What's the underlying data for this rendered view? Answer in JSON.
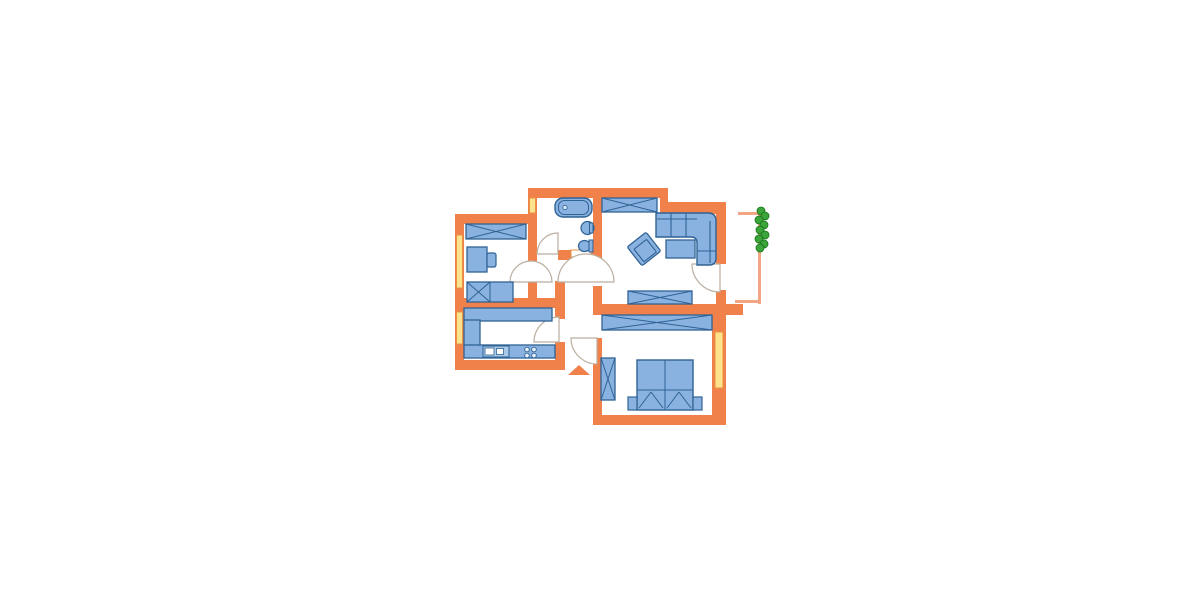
{
  "meta": {
    "description": "apartment floor plan drawing, no text labels visible",
    "entrance_marker": "orange triangle arrow pointing into hallway",
    "rooms": [
      {
        "name": "children-room",
        "position": "top-left",
        "furniture": [
          "wardrobe",
          "desk",
          "desk-chair",
          "single-bed"
        ],
        "windows": 1
      },
      {
        "name": "bathroom",
        "position": "top-middle",
        "furniture": [
          "bathtub",
          "washbasin",
          "toilet",
          "shelf-niche"
        ],
        "windows": 1
      },
      {
        "name": "living-room",
        "position": "top-right",
        "furniture": [
          "wardrobe",
          "corner-sofa",
          "armchair",
          "coffee-table",
          "sideboard"
        ]
      },
      {
        "name": "balcony",
        "position": "right",
        "furniture": [
          "railing",
          "plant"
        ]
      },
      {
        "name": "kitchen",
        "position": "bottom-left",
        "furniture": [
          "counter-u-shape",
          "sink-unit",
          "stove-4-burners"
        ],
        "windows": 1
      },
      {
        "name": "bedroom",
        "position": "bottom-right",
        "furniture": [
          "long-wardrobe",
          "tall-wardrobe",
          "double-bed",
          "nightstand-left",
          "nightstand-right"
        ],
        "windows": 1
      },
      {
        "name": "hallway",
        "position": "center",
        "furniture": []
      }
    ]
  },
  "palette": {
    "wall": "#F0814B",
    "window_fill": "#FFE28E",
    "window_stroke": "#E8933F",
    "furniture_fill": "#8AB2E0",
    "furniture_stroke": "#2F6295",
    "door_arc_stroke": "#BBAE9F",
    "railing": "#F2A585",
    "plant_fill": "#3BA43B",
    "plant_stroke": "#177417",
    "floor": "#FFFFFF"
  },
  "plan": {
    "elements": [
      {
        "n": "wall-bathroom-top",
        "t": "rect",
        "x": 528,
        "y": 188,
        "w": 140,
        "h": 10,
        "f": "#F0814B"
      },
      {
        "n": "wall-top-step",
        "t": "rect",
        "x": 660,
        "y": 188,
        "w": 8,
        "h": 26,
        "f": "#F0814B"
      },
      {
        "n": "wall-living-top",
        "t": "rect",
        "x": 660,
        "y": 202,
        "w": 66,
        "h": 12,
        "f": "#F0814B"
      },
      {
        "n": "wall-bathroom-left",
        "t": "rect",
        "x": 528,
        "y": 188,
        "w": 9,
        "h": 73,
        "f": "#F0814B"
      },
      {
        "n": "wall-children-top",
        "t": "rect",
        "x": 455,
        "y": 214,
        "w": 82,
        "h": 10,
        "f": "#F0814B"
      },
      {
        "n": "wall-children-left",
        "t": "rect",
        "x": 455,
        "y": 214,
        "w": 9,
        "h": 94,
        "f": "#F0814B"
      },
      {
        "n": "wall-children-right-upper",
        "t": "rect",
        "x": 528,
        "y": 224,
        "w": 9,
        "h": 37,
        "f": "#F0814B"
      },
      {
        "n": "wall-children-right-lower",
        "t": "rect",
        "x": 528,
        "y": 281,
        "w": 9,
        "h": 19,
        "f": "#F0814B"
      },
      {
        "n": "wall-kitchen-top",
        "t": "rect",
        "x": 455,
        "y": 298,
        "w": 110,
        "h": 10,
        "f": "#F0814B"
      },
      {
        "n": "wall-kitchen-left",
        "t": "rect",
        "x": 455,
        "y": 298,
        "w": 9,
        "h": 72,
        "f": "#F0814B"
      },
      {
        "n": "wall-kitchen-bottom",
        "t": "rect",
        "x": 455,
        "y": 360,
        "w": 110,
        "h": 10,
        "f": "#F0814B"
      },
      {
        "n": "wall-kitchen-right-upper",
        "t": "rect",
        "x": 555,
        "y": 281,
        "w": 10,
        "h": 38,
        "f": "#F0814B"
      },
      {
        "n": "wall-kitchen-right-lower",
        "t": "rect",
        "x": 555,
        "y": 342,
        "w": 10,
        "h": 28,
        "f": "#F0814B"
      },
      {
        "n": "wall-bathroom-bottom",
        "t": "rect",
        "x": 558,
        "y": 250,
        "w": 44,
        "h": 10,
        "f": "#F0814B"
      },
      {
        "n": "wall-living-left-upper",
        "t": "rect",
        "x": 593,
        "y": 198,
        "w": 9,
        "h": 60,
        "f": "#F0814B"
      },
      {
        "n": "wall-living-left-lower",
        "t": "rect",
        "x": 593,
        "y": 286,
        "w": 9,
        "h": 18,
        "f": "#F0814B"
      },
      {
        "n": "wall-living-bottom",
        "t": "rect",
        "x": 593,
        "y": 304,
        "w": 150,
        "h": 11,
        "f": "#F0814B"
      },
      {
        "n": "wall-living-right-upper",
        "t": "rect",
        "x": 716,
        "y": 212,
        "w": 10,
        "h": 52,
        "f": "#F0814B"
      },
      {
        "n": "wall-living-right-lower",
        "t": "rect",
        "x": 716,
        "y": 290,
        "w": 10,
        "h": 14,
        "f": "#F0814B"
      },
      {
        "n": "wall-bedroom-left",
        "t": "rect",
        "x": 593,
        "y": 338,
        "w": 9,
        "h": 87,
        "f": "#F0814B"
      },
      {
        "n": "wall-bedroom-right",
        "t": "rect",
        "x": 712,
        "y": 304,
        "w": 14,
        "h": 121,
        "f": "#F0814B"
      },
      {
        "n": "wall-bedroom-bottom",
        "t": "rect",
        "x": 593,
        "y": 415,
        "w": 133,
        "h": 10,
        "f": "#F0814B"
      },
      {
        "n": "window-bathroom",
        "t": "rect",
        "x": 529.5,
        "y": 198,
        "w": 6,
        "h": 15,
        "f": "#FFE28E",
        "s": "#E8933F",
        "sw": 1
      },
      {
        "n": "window-children",
        "t": "rect",
        "x": 456.5,
        "y": 235,
        "w": 6,
        "h": 53,
        "f": "#FFE28E",
        "s": "#E8933F",
        "sw": 1
      },
      {
        "n": "window-kitchen",
        "t": "rect",
        "x": 456.5,
        "y": 312,
        "w": 6,
        "h": 32,
        "f": "#FFE28E",
        "s": "#E8933F",
        "sw": 1
      },
      {
        "n": "window-bedroom",
        "t": "rect",
        "x": 715,
        "y": 332,
        "w": 8,
        "h": 56,
        "f": "#FFE28E",
        "s": "#E8933F",
        "sw": 1
      },
      {
        "n": "balcony-railing-top",
        "t": "rect",
        "x": 738,
        "y": 212,
        "w": 23,
        "h": 3,
        "f": "#F2A585"
      },
      {
        "n": "balcony-railing-right",
        "t": "rect",
        "x": 758,
        "y": 212,
        "w": 3,
        "h": 92,
        "f": "#F2A585"
      },
      {
        "n": "balcony-railing-bottom",
        "t": "rect",
        "x": 735,
        "y": 300,
        "w": 26,
        "h": 3,
        "f": "#F2A585"
      },
      {
        "n": "bathroom-shelf-niche",
        "t": "rect",
        "x": 571,
        "y": 250,
        "w": 20,
        "h": 7,
        "f": "#FFFFFF",
        "s": "#E8933F",
        "sw": 1
      },
      {
        "n": "door-swing-children-room",
        "t": "path",
        "d": "M510,282 A21,21 0 0 1 552,282 Z",
        "f": "#FFFFFF",
        "s": "#BBAE9F",
        "sw": 1.2
      },
      {
        "n": "door-swing-living-room",
        "t": "path",
        "d": "M558,282 A28,28 0 0 1 614,282 Z",
        "f": "#FFFFFF",
        "s": "#BBAE9F",
        "sw": 1.2
      },
      {
        "n": "door-swing-bathroom",
        "t": "path",
        "d": "M558,254 L537,254 A21,21 0 0 1 558,233 Z",
        "f": "#FFFFFF",
        "s": "#BBAE9F",
        "sw": 1.2
      },
      {
        "n": "door-swing-kitchen",
        "t": "path",
        "d": "M559,342 L559,317 A25,25 0 0 0 534,342 Z",
        "f": "#FFFFFF",
        "s": "#BBAE9F",
        "sw": 1.2
      },
      {
        "n": "door-swing-bedroom",
        "t": "path",
        "d": "M597,338 L571,338 A26,26 0 0 0 597,364 Z",
        "f": "#FFFFFF",
        "s": "#BBAE9F",
        "sw": 1.2
      },
      {
        "n": "door-swing-balcony",
        "t": "path",
        "d": "M720,264 L692,264 A28,28 0 0 0 720,292 Z",
        "f": "#FFFFFF",
        "s": "#BBAE9F",
        "sw": 1.2
      },
      {
        "n": "children-wardrobe",
        "t": "crossbox",
        "x": 466,
        "y": 224,
        "w": 60,
        "h": 15,
        "f": "#8AB2E0",
        "s": "#2F6295",
        "sw": 1.3
      },
      {
        "n": "children-desk",
        "t": "rect",
        "x": 467,
        "y": 247,
        "w": 20,
        "h": 25,
        "f": "#8AB2E0",
        "s": "#2F6295",
        "sw": 1.3
      },
      {
        "n": "children-desk-chair",
        "t": "rect",
        "x": 487,
        "y": 253,
        "w": 9,
        "h": 14,
        "cr": 2,
        "f": "#8AB2E0",
        "s": "#2F6295",
        "sw": 1.2
      },
      {
        "n": "children-single-bed",
        "t": "box",
        "x": 467,
        "y": 282,
        "w": 46,
        "h": 20,
        "f": "#8AB2E0",
        "s": "#2F6295",
        "sw": 1.3,
        "lines": [
          [
            490,
            282,
            490,
            302
          ],
          [
            467,
            302,
            490,
            282
          ],
          [
            467,
            282,
            490,
            302
          ]
        ]
      },
      {
        "n": "bathtub",
        "t": "rect",
        "x": 555,
        "y": 198,
        "w": 37,
        "h": 19,
        "cr": 8,
        "f": "#8AB2E0",
        "s": "#2F6295",
        "sw": 1.4
      },
      {
        "n": "bathtub-inner",
        "t": "rect",
        "x": 558.5,
        "y": 200.5,
        "w": 30,
        "h": 14,
        "cr": 6,
        "f": "none",
        "s": "#2F6295",
        "sw": 1
      },
      {
        "n": "bathtub-drain",
        "t": "circle",
        "cx": 565,
        "cy": 207.5,
        "r": 2.2,
        "f": "#D8E8F8",
        "s": "#2F6295",
        "sw": 0.8
      },
      {
        "n": "washbasin",
        "t": "circle",
        "cx": 587.5,
        "cy": 228,
        "r": 6.5,
        "f": "#8AB2E0",
        "s": "#2F6295",
        "sw": 1.2
      },
      {
        "n": "washbasin-pedestal",
        "t": "rect",
        "x": 589.5,
        "y": 223,
        "w": 3.5,
        "h": 10,
        "f": "#8AB2E0",
        "s": "#2F6295",
        "sw": 1
      },
      {
        "n": "toilet-bowl",
        "t": "ellipse",
        "cx": 584.5,
        "cy": 246,
        "rx": 6,
        "ry": 5.5,
        "f": "#8AB2E0",
        "s": "#2F6295",
        "sw": 1.2
      },
      {
        "n": "toilet-tank",
        "t": "rect",
        "x": 589,
        "y": 240,
        "w": 4,
        "h": 12,
        "f": "#8AB2E0",
        "s": "#2F6295",
        "sw": 1
      },
      {
        "n": "living-wardrobe",
        "t": "crossbox",
        "x": 602,
        "y": 198,
        "w": 55,
        "h": 14,
        "f": "#8AB2E0",
        "s": "#2F6295",
        "sw": 1.3
      },
      {
        "n": "corner-sofa",
        "t": "path",
        "d": "M656,213 L708,213 Q716,213 716,221 L716,258 Q716,265 709,265 L697,265 L697,243 Q697,237 691,237 L656,237 Z",
        "f": "#8AB2E0",
        "s": "#2F6295",
        "sw": 1.4
      },
      {
        "n": "sofa-cushion-line-1",
        "t": "line",
        "x1": 671,
        "y1": 213,
        "x2": 671,
        "y2": 237,
        "s": "#2F6295",
        "sw": 1.1
      },
      {
        "n": "sofa-cushion-line-2",
        "t": "line",
        "x1": 686,
        "y1": 213,
        "x2": 686,
        "y2": 237,
        "s": "#2F6295",
        "sw": 1.1
      },
      {
        "n": "sofa-back-line-top",
        "t": "line",
        "x1": 657,
        "y1": 219,
        "x2": 697,
        "y2": 219,
        "s": "#2F6295",
        "sw": 1.1
      },
      {
        "n": "sofa-back-line-right",
        "t": "line",
        "x1": 710,
        "y1": 221,
        "x2": 710,
        "y2": 263,
        "s": "#2F6295",
        "sw": 1.1
      },
      {
        "n": "sofa-cushion-line-3",
        "t": "line",
        "x1": 697,
        "y1": 251,
        "x2": 716,
        "y2": 251,
        "s": "#2F6295",
        "sw": 1.1
      },
      {
        "n": "armchair",
        "t": "rect",
        "x": 632,
        "y": 237,
        "w": 24,
        "h": 24,
        "cr": 2,
        "f": "#8AB2E0",
        "s": "#2F6295",
        "sw": 1.3,
        "tr": "rotate(-38 644 249)"
      },
      {
        "n": "armchair-seat",
        "t": "rect",
        "x": 636,
        "y": 243,
        "w": 16,
        "h": 16,
        "cr": 1,
        "f": "#8AB2E0",
        "s": "#2F6295",
        "sw": 1.1,
        "tr": "rotate(-38 644 249)"
      },
      {
        "n": "coffee-table",
        "t": "rect",
        "x": 666,
        "y": 240,
        "w": 29,
        "h": 18,
        "f": "#8AB2E0",
        "s": "#2F6295",
        "sw": 1.3
      },
      {
        "n": "living-sideboard",
        "t": "crossbox",
        "x": 628,
        "y": 291,
        "w": 64,
        "h": 13,
        "f": "#8AB2E0",
        "s": "#2F6295",
        "sw": 1.3
      },
      {
        "n": "kitchen-counter-top",
        "t": "rect",
        "x": 464,
        "y": 308,
        "w": 88,
        "h": 13,
        "f": "#8AB2E0",
        "s": "#2F6295",
        "sw": 1.3
      },
      {
        "n": "kitchen-counter-left",
        "t": "rect",
        "x": 464,
        "y": 320,
        "w": 16,
        "h": 26,
        "f": "#8AB2E0",
        "s": "#2F6295",
        "sw": 1.3
      },
      {
        "n": "kitchen-counter-bottom",
        "t": "rect",
        "x": 464,
        "y": 345,
        "w": 91,
        "h": 13,
        "f": "#8AB2E0",
        "s": "#2F6295",
        "sw": 1.3
      },
      {
        "n": "kitchen-sink-unit",
        "t": "rect",
        "x": 483,
        "y": 346,
        "w": 26,
        "h": 11,
        "f": "#AAC8E8",
        "s": "#2F6295",
        "sw": 1
      },
      {
        "n": "kitchen-sink-basin-1",
        "t": "rect",
        "x": 485,
        "y": 348,
        "w": 9,
        "h": 7,
        "f": "#FFFFFF",
        "s": "#2F6295",
        "sw": 0.8
      },
      {
        "n": "kitchen-sink-basin-2",
        "t": "rect",
        "x": 496.5,
        "y": 348.5,
        "w": 7,
        "h": 6,
        "f": "#FFFFFF",
        "s": "#2F6295",
        "sw": 0.8
      },
      {
        "n": "stove-burner-1",
        "t": "circle",
        "cx": 527,
        "cy": 349.5,
        "r": 2.3,
        "f": "#E8F1FA",
        "s": "#2F6295",
        "sw": 0.9
      },
      {
        "n": "stove-burner-2",
        "t": "circle",
        "cx": 534,
        "cy": 349.5,
        "r": 2.3,
        "f": "#E8F1FA",
        "s": "#2F6295",
        "sw": 0.9
      },
      {
        "n": "stove-burner-3",
        "t": "circle",
        "cx": 527,
        "cy": 355.5,
        "r": 2.3,
        "f": "#E8F1FA",
        "s": "#2F6295",
        "sw": 0.9
      },
      {
        "n": "stove-burner-4",
        "t": "circle",
        "cx": 534,
        "cy": 355.5,
        "r": 2.3,
        "f": "#E8F1FA",
        "s": "#2F6295",
        "sw": 0.9
      },
      {
        "n": "bedroom-wardrobe-long",
        "t": "crossbox",
        "x": 602,
        "y": 315,
        "w": 110,
        "h": 15,
        "f": "#8AB2E0",
        "s": "#2F6295",
        "sw": 1.3
      },
      {
        "n": "bedroom-wardrobe-tall",
        "t": "crossbox",
        "x": 601,
        "y": 358,
        "w": 14,
        "h": 42,
        "f": "#8AB2E0",
        "s": "#2F6295",
        "sw": 1.3
      },
      {
        "n": "double-bed",
        "t": "box",
        "x": 637,
        "y": 360,
        "w": 56,
        "h": 50,
        "f": "#8AB2E0",
        "s": "#2F6295",
        "sw": 1.4,
        "lines": [
          [
            665,
            360,
            665,
            410
          ],
          [
            637,
            390,
            693,
            390
          ],
          [
            639,
            408,
            651,
            392
          ],
          [
            651,
            392,
            663,
            408
          ],
          [
            667,
            408,
            679,
            392
          ],
          [
            679,
            392,
            691,
            408
          ]
        ]
      },
      {
        "n": "nightstand-left",
        "t": "rect",
        "x": 628,
        "y": 397,
        "w": 9,
        "h": 13,
        "f": "#8AB2E0",
        "s": "#2F6295",
        "sw": 1.2
      },
      {
        "n": "nightstand-right",
        "t": "rect",
        "x": 693,
        "y": 397,
        "w": 9,
        "h": 13,
        "f": "#8AB2E0",
        "s": "#2F6295",
        "sw": 1.2
      },
      {
        "n": "balcony-plant-1",
        "t": "circle",
        "cx": 761,
        "cy": 211,
        "r": 4,
        "f": "#3BA43B",
        "s": "#177417",
        "sw": 0.8
      },
      {
        "n": "balcony-plant-2",
        "t": "circle",
        "cx": 765,
        "cy": 216,
        "r": 4,
        "f": "#3BA43B",
        "s": "#177417",
        "sw": 0.8
      },
      {
        "n": "balcony-plant-3",
        "t": "circle",
        "cx": 759,
        "cy": 220,
        "r": 4,
        "f": "#3BA43B",
        "s": "#177417",
        "sw": 0.8
      },
      {
        "n": "balcony-plant-4",
        "t": "circle",
        "cx": 764,
        "cy": 225,
        "r": 4,
        "f": "#3BA43B",
        "s": "#177417",
        "sw": 0.8
      },
      {
        "n": "balcony-plant-5",
        "t": "circle",
        "cx": 760,
        "cy": 230,
        "r": 4,
        "f": "#3BA43B",
        "s": "#177417",
        "sw": 0.8
      },
      {
        "n": "balcony-plant-6",
        "t": "circle",
        "cx": 765,
        "cy": 235,
        "r": 4,
        "f": "#3BA43B",
        "s": "#177417",
        "sw": 0.8
      },
      {
        "n": "balcony-plant-7",
        "t": "circle",
        "cx": 759,
        "cy": 239,
        "r": 4,
        "f": "#3BA43B",
        "s": "#177417",
        "sw": 0.8
      },
      {
        "n": "balcony-plant-8",
        "t": "circle",
        "cx": 764,
        "cy": 244,
        "r": 4,
        "f": "#3BA43B",
        "s": "#177417",
        "sw": 0.8
      },
      {
        "n": "balcony-plant-9",
        "t": "circle",
        "cx": 760,
        "cy": 248,
        "r": 4,
        "f": "#3BA43B",
        "s": "#177417",
        "sw": 0.8
      },
      {
        "n": "entrance-arrow",
        "t": "path",
        "d": "M568,375 L590,375 L579,365 Z",
        "f": "#F0814B"
      }
    ]
  }
}
